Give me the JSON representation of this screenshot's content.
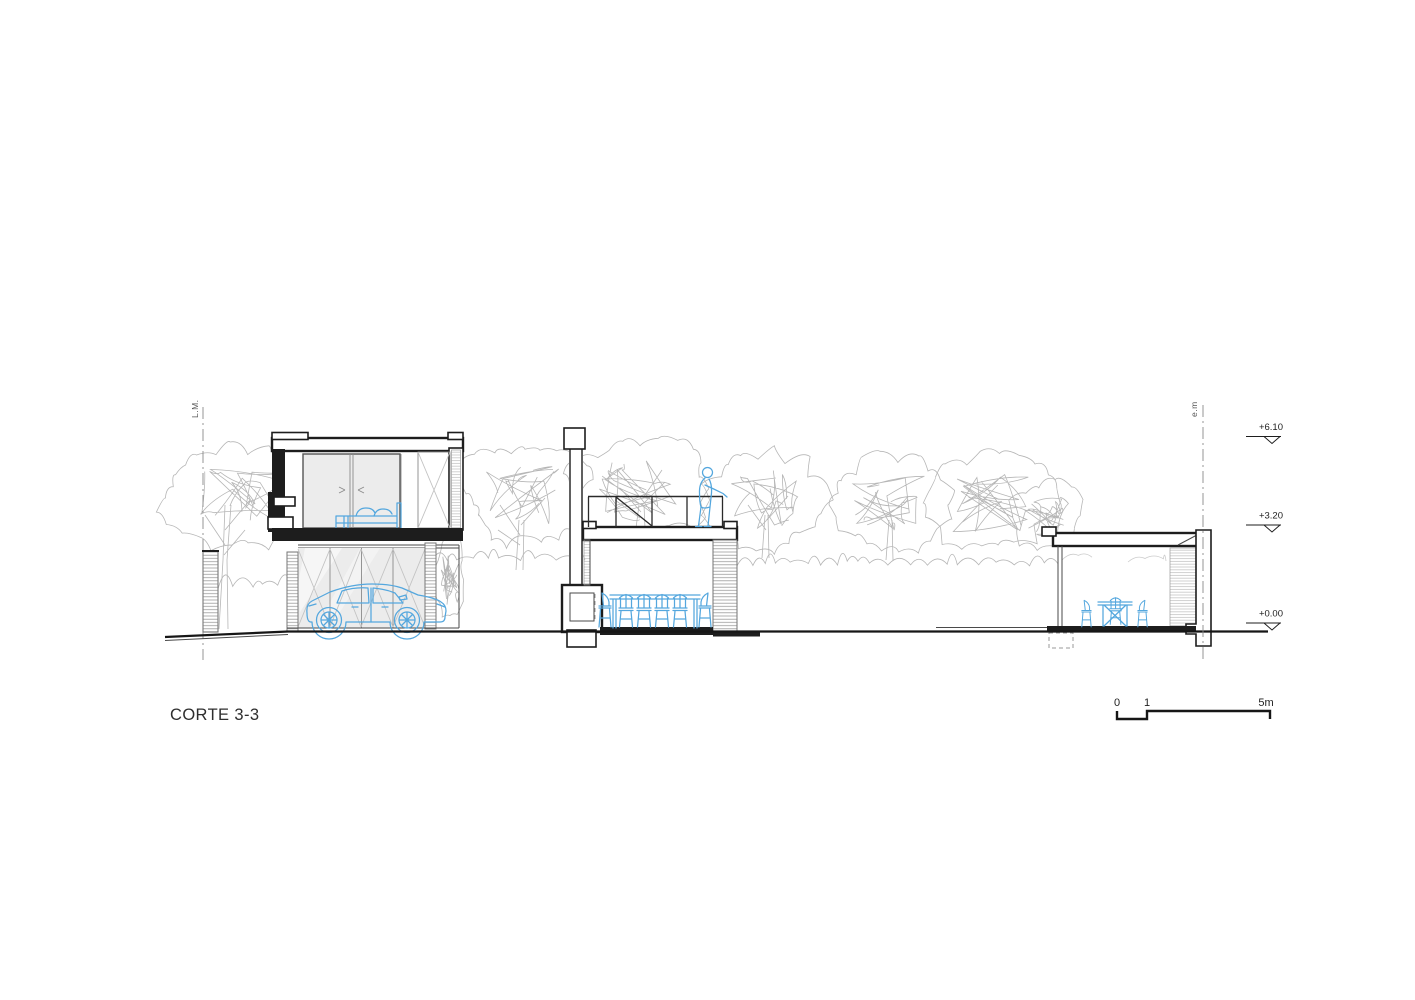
{
  "title": "CORTE 3-3",
  "labels": {
    "boundary_left": "L.M.",
    "boundary_right": "e.m"
  },
  "levels": [
    {
      "label": "+6.10"
    },
    {
      "label": "+3.20"
    },
    {
      "label": "+0.00"
    }
  ],
  "scale_bar": {
    "start": "0",
    "mid": "1",
    "end": "5m"
  },
  "colors": {
    "line": "#1d1d1d",
    "thin": "#4a4a4a",
    "tree": "#b6b6b6",
    "hatch": "#959595",
    "glass": "#ececec",
    "blue": "#54a7de",
    "text": "#2e2e2e",
    "bg": "#ffffff"
  }
}
